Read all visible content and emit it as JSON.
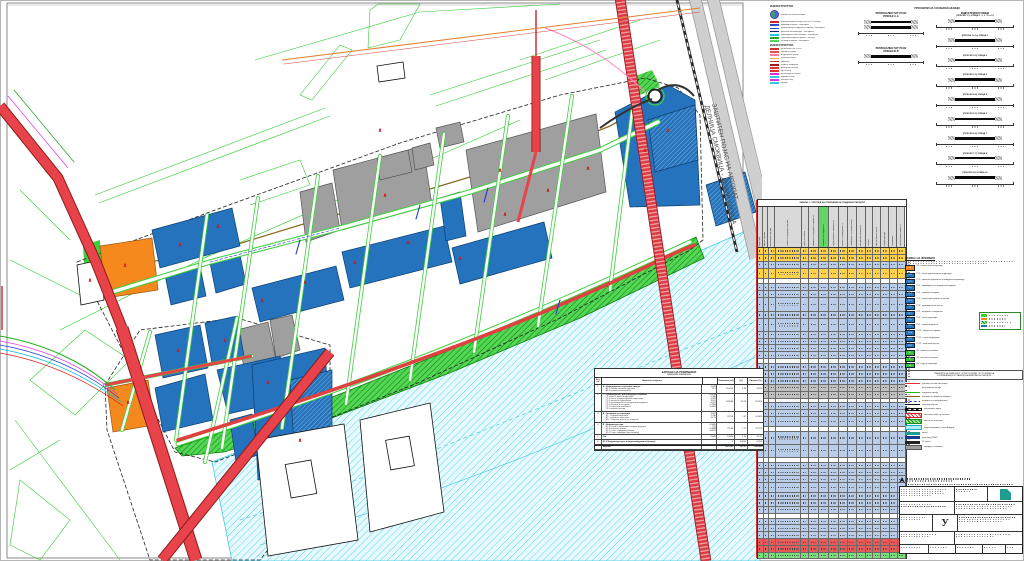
{
  "palette": {
    "cadastral": "#33cc33",
    "road_red": "#e8434b",
    "road_dark": "#8b1a1a",
    "blue_parcel": "#2473bc",
    "blue_dark": "#0c3f73",
    "gray_parcel": "#9f9f9f",
    "orange_parcel": "#f5891d",
    "green_strip": "#3ecf3e",
    "green_dark": "#0c8c0c",
    "water_line": "#35c4de",
    "water_fill": "#e6fafd",
    "highway_gray": "#cfcfcf",
    "table_yellow": "#ffd24d",
    "table_blue": "#b9cde8",
    "table_green": "#63d663",
    "table_red": "#e85a5a",
    "stamp_teal": "#1f9e8e"
  },
  "map": {
    "highway_label_line1": "ЗАШТИТЕН ПОЈАС НА АВТОПАТ",
    "highway_label_line2": "ДЕЛНИЦА СМОКВИЦА - ДЕМИР КАПИЈА"
  },
  "legend_infra": {
    "title1": "ИНФРАСТРУКТУРА",
    "stamp_label": "граница на плански опфат",
    "rows1": [
      {
        "color": "#cc2222",
        "label": "електроенергетски вод 10(20)kV - постојна"
      },
      {
        "color": "#2a52c8",
        "label": "водоводна мрежа - планирана"
      },
      {
        "color": "#2a52c8",
        "label": "противпожарна хидрантска мрежа - планирана"
      },
      {
        "color": "#15246e",
        "label": "фекална канализација - планирана"
      },
      {
        "color": "#27c3e2",
        "label": "атмосферска канализација - планирана"
      },
      {
        "color": "#21a821",
        "label": "телекомуникациска мрежа - постојна"
      },
      {
        "color": "#56d656",
        "label": "гасоводна мрежа - планирана"
      }
    ],
    "title2": "ИНФРАСТРУКТУРА",
    "rows2": [
      {
        "color": "#d43030",
        "label": "регионален пат Р1102"
      },
      {
        "color": "#e05050",
        "label": "сервисни улици"
      },
      {
        "color": "#f080a0",
        "label": "индустриски улици"
      },
      {
        "color": "#e8b040",
        "label": "пешачки патеки"
      },
      {
        "color": "#d43030",
        "label": "тротоари"
      },
      {
        "color": "#a01818",
        "label": "паркинг површини"
      },
      {
        "color": "#e03030",
        "label": "автобуски постојки"
      },
      {
        "color": "#e03030",
        "label": "крстосници"
      },
      {
        "color": "#d830d8",
        "label": "велосипедска патека"
      },
      {
        "color": "#30c8e8",
        "label": "одводен канал"
      },
      {
        "color": "#d830d8",
        "label": "потпорен ѕид"
      },
      {
        "color": "#30c8e8",
        "label": "пропуст"
      }
    ]
  },
  "profiles": {
    "title": "ПРОФИЛИ НА СООБРАЌАЈНИЦИ",
    "left_groups": [
      {
        "t1": "РЕГИОНАЛЕН ПАТ Р1102",
        "t2": "ПРЕСЕК А-А",
        "bars": 2
      },
      {
        "t1": "РЕГИОНАЛЕН ПАТ Р1102",
        "t2": "ПРЕСЕК Б-Б",
        "bars": 1
      }
    ],
    "right_title": "ИНДУСТРИСКИ УЛИЦИ",
    "sections": [
      "(ПРЕСЕК 1-1)  УЛИЦА 1, 2, 3, 11 и 12",
      "(ПРЕСЕК 1а-1а)  УЛИЦА 1",
      "(ПРЕСЕК 2-2)  УЛИЦА 2",
      "(ПРЕСЕК 3-3)  УЛИЦА 3",
      "(ПРЕСЕК 4-4)  УЛИЦА 4",
      "(ПРЕСЕК 5-5)  УЛИЦА 5",
      "(ПРЕСЕК 6-6)  УЛИЦА 7",
      "(ПРЕСЕК 7-7)  УЛИЦА 8",
      "(ПРЕСЕК 8-8)  УЛИЦА 10"
    ]
  },
  "big_table": {
    "title": "ТАБЕЛА 1 - ПРЕГЛЕД НА ПОВРШИНИ НА ГРАДЕЖНИ ПАРЦЕЛИ",
    "headers": [
      "реден број",
      "број на парцела",
      "катастарска парцела",
      "намена на градежна парцела",
      "класа на намена",
      "површина на градежна парцела м2",
      "површина за градење м2",
      "бруто развиена површина м2",
      "процент на изграденост %",
      "коефициент на искористеност",
      "максимална височина м",
      "катност",
      "број на паркинг места",
      "инфраструктура",
      "забелешка",
      "компатибилна намена %"
    ],
    "col_widths": [
      4,
      4,
      6,
      26,
      6,
      9,
      9,
      9,
      8,
      8,
      8,
      6,
      7,
      7,
      7,
      7
    ],
    "green_col": 6,
    "rows": [
      {
        "h": 6,
        "c": "y"
      },
      {
        "h": 6,
        "c": "y"
      },
      {
        "h": 6,
        "c": "b"
      },
      {
        "h": 10,
        "c": "y"
      },
      {
        "h": 4,
        "c": "w"
      },
      {
        "h": 6,
        "c": "b"
      },
      {
        "h": 6,
        "c": "b"
      },
      {
        "h": 13,
        "c": "b"
      },
      {
        "h": 6,
        "c": "b"
      },
      {
        "h": 12,
        "c": "b"
      },
      {
        "h": 6,
        "c": "b"
      },
      {
        "h": 6,
        "c": "b"
      },
      {
        "h": 6,
        "c": "b"
      },
      {
        "h": 6,
        "c": "b"
      },
      {
        "h": 4,
        "c": "w"
      },
      {
        "h": 6,
        "c": "b"
      },
      {
        "h": 6,
        "c": "b"
      },
      {
        "h": 6,
        "c": "b"
      },
      {
        "h": 6,
        "c": "g2"
      },
      {
        "h": 6,
        "c": "g2"
      },
      {
        "h": 4,
        "c": "w"
      },
      {
        "h": 6,
        "c": "b"
      },
      {
        "h": 6,
        "c": "b"
      },
      {
        "h": 9,
        "c": "b"
      },
      {
        "h": 4,
        "c": "w"
      },
      {
        "h": 12,
        "c": "b"
      },
      {
        "h": 12,
        "c": "b"
      },
      {
        "h": 4,
        "c": "w"
      },
      {
        "h": 6,
        "c": "b"
      },
      {
        "h": 6,
        "c": "b"
      },
      {
        "h": 6,
        "c": "b"
      },
      {
        "h": 9,
        "c": "b"
      },
      {
        "h": 6,
        "c": "b"
      },
      {
        "h": 6,
        "c": "b"
      },
      {
        "h": 6,
        "c": "b"
      },
      {
        "h": 4,
        "c": "w"
      },
      {
        "h": 6,
        "c": "b"
      },
      {
        "h": 6,
        "c": "b"
      },
      {
        "h": 6,
        "c": "b"
      },
      {
        "h": 6,
        "c": "r"
      },
      {
        "h": 6,
        "c": "r"
      },
      {
        "h": 5,
        "c": "gr"
      }
    ]
  },
  "namena": {
    "title": "НАМЕНА НА ЗЕМЈИШТЕ",
    "intro_lines": 2,
    "orange_row": {
      "code": "Б2",
      "label": "големи трговски единици"
    },
    "blue_rows": [
      {
        "code": "Г2.1",
        "label": "лесна преработувачка индустрија"
      },
      {
        "code": "Г2.2",
        "label": "погони за преработка на земјоделски производи"
      },
      {
        "code": "Г2.3",
        "label": "производство на градежни материјали"
      },
      {
        "code": "Г2.4",
        "label": "сервиси и складови"
      },
      {
        "code": "Г2.5",
        "label": "откупно-дистрибутивни центри"
      },
      {
        "code": "Г2.6",
        "label": "производствени погони"
      },
      {
        "code": "Г2.7",
        "label": "магацини и стоваришта"
      },
      {
        "code": "Г2.8",
        "label": "лесна индустрија"
      },
      {
        "code": "Г2.9",
        "label": "сервисни дејности"
      },
      {
        "code": "Г2.10",
        "label": "комунални сервиси"
      },
      {
        "code": "Г2.11",
        "label": "стопански дворови"
      },
      {
        "code": "Г2.12",
        "label": "логистички центар"
      }
    ],
    "green_rows": [
      {
        "code": "Д1",
        "label": "парковско зеленило"
      },
      {
        "code": "Д2",
        "label": "заштитно зеленило"
      },
      {
        "code": "Д3",
        "label": "спорт и рекреација"
      }
    ],
    "note_line1": "ГРАНИЦИТЕ НА ПЛАНСКИОТ ОПФАТ СЕ ВОДАТ ПО ОСОВИНИ НА",
    "note_line2": "СООБРАЌАЈНИЦИ И ГРАНИЦИ НА КАТАСТАРСКИ ПАРЦЕЛИ",
    "line_rows": [
      {
        "cls": "lc-red-thick",
        "label": "граница на плански опфат"
      },
      {
        "cls": "lc-red-thin",
        "label": "регулациона линија"
      },
      {
        "cls": "lc-green",
        "label": "градежна линија"
      },
      {
        "cls": "lc-olive",
        "label": "граница на градежна парцела"
      },
      {
        "cls": "lc-blue-dash",
        "label": "осовина на сообраќајница"
      },
      {
        "cls": "lc-black",
        "label": "постојни објекти"
      },
      {
        "cls": "lc-rail",
        "label": "железничка пруга"
      },
      {
        "cls": "lc-hatch-red",
        "label": "заштитен појас на автопат"
      },
      {
        "cls": "lc-hatch-green",
        "label": "заштитно зеленило"
      },
      {
        "cls": "lc-cyan-box",
        "label": "водна површина - река Вардар"
      },
      {
        "cls": "lc-teal-box",
        "label": "канал"
      },
      {
        "cls": "lc-navy-box",
        "label": "далновод 110kV"
      },
      {
        "cls": "lc-black-box",
        "label": "ТТ врски"
      },
      {
        "cls": "lc-gray-box",
        "label": "коридор на автопат"
      }
    ]
  },
  "balance": {
    "title1": "БИЛАНС НА ПОВРШИНИ",
    "title2": "нумерички показатели",
    "col_headers": [
      "Ред. бр.",
      "Намена на земјиште",
      "Површина (м2)",
      "(%)",
      "Процент (%)"
    ],
    "groups": [
      {
        "num": "1.",
        "label": "А - Комерцијални и деловни намени",
        "subs": [
          {
            "l": "А1.2 големи трговски единици",
            "v": "4.028"
          },
          {
            "l": "А4.3 времено сместување",
            "v": "15.2"
          }
        ],
        "area": "110058",
        "p1": "4.39",
        "p2": "4.63%"
      },
      {
        "num": "2.",
        "label": "Г - Производство, дистрибуција и сервиси",
        "subs": [
          {
            "l": "Г1 тешка и базна индустрија",
            "v": "0.9918"
          },
          {
            "l": "Г2.1 лесна преработувачка индустрија",
            "v": "2.580"
          },
          {
            "l": "Г2.2 погони за преработка",
            "v": "3.281"
          },
          {
            "l": "Г2.3 производство на градежни материјали",
            "v": "15.87"
          },
          {
            "l": "Г2.4 сервиси и складови",
            "v": "4.912"
          },
          {
            "l": "Г3.1 стопански комплекси",
            "v": "2.7804"
          },
          {
            "l": "Г3.5 откупни центри",
            "v": "5.0023"
          }
        ],
        "area": "307688",
        "p1": "30.74",
        "p2": "85.35%"
      },
      {
        "num": "3.",
        "label": "Д - Зеленило и рекреација",
        "subs": [
          {
            "l": "Д1 - Паркови зеленило",
            "v": "3.097"
          },
          {
            "l": "Д2 - заштитно зеленило",
            "v": "1.708"
          },
          {
            "l": "Д3 - Спортски терени на отворено",
            "v": "10.15"
          }
        ],
        "area": "23790",
        "p1": "1.37",
        "p2": "14.88%"
      },
      {
        "num": "4.",
        "label": "Е - Инфраструктура",
        "subs": [
          {
            "l": "Е1.1 патна и железничка инфраструктура",
            "v": "0.5683"
          },
          {
            "l": "Е1.8 пешачки патеки",
            "v": "555"
          },
          {
            "l": "Е3.1 Соор. коридори (влезни)",
            "v": "2.0848"
          },
          {
            "l": "Е3.2 Соор. коридори (крстосници)",
            "v": "4.8012"
          }
        ],
        "area": "77936",
        "p1": "7.75",
        "p2": "22.75%"
      },
      {
        "num": "5.",
        "label": "Пат",
        "subs": [
          {
            "l": "",
            "v": "13986"
          }
        ],
        "area": "13986",
        "p1": "1.30",
        "p2": "3.14%"
      },
      {
        "num": "6.",
        "label": "Е1.3 Инфраструктура за водоснабдување (бунари)",
        "subs": [],
        "area": "0",
        "p1": "0.8003",
        "p2": "0.83%"
      }
    ],
    "total_label": "Вкупно:",
    "total_area": "1073741",
    "total_p1": "10.737",
    "total_p2": "100.00%"
  },
  "title_block": {
    "big_letter": "У"
  }
}
